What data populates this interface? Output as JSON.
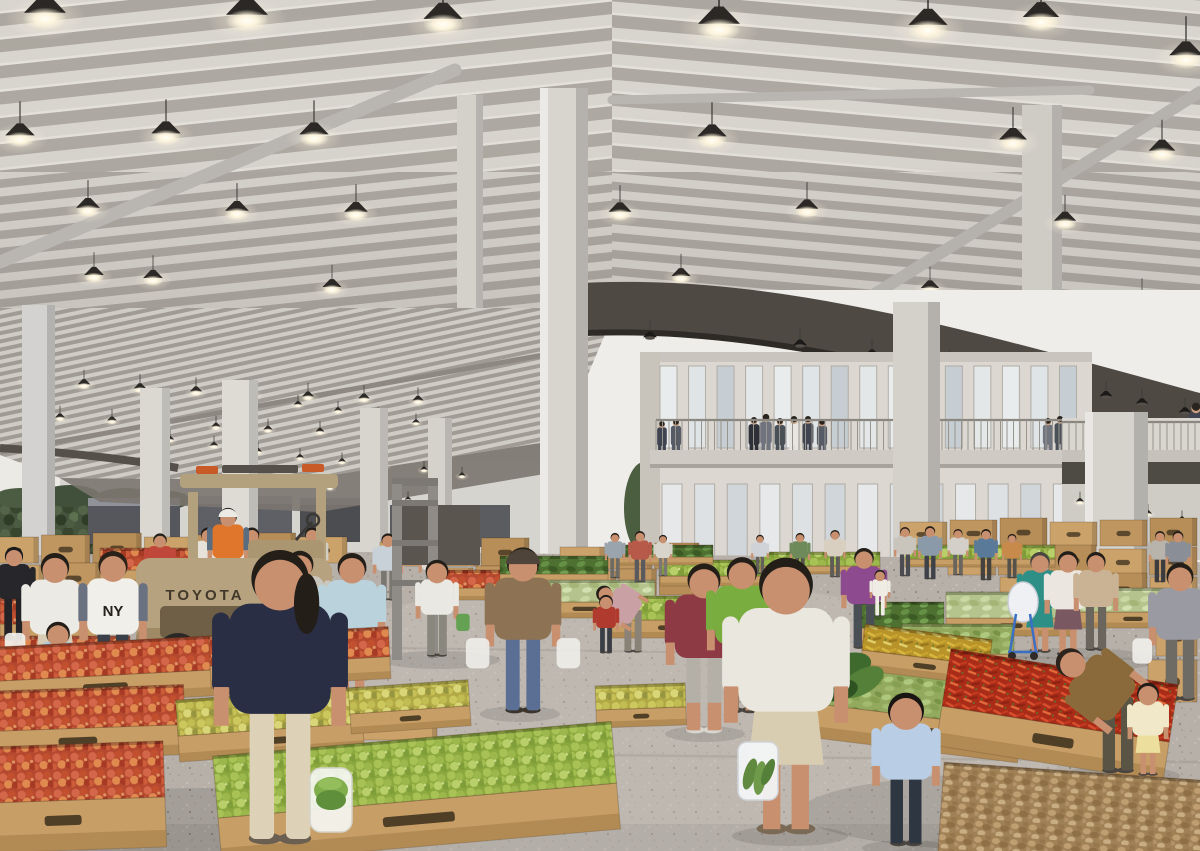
{
  "scene": {
    "title": "Covered fruit and vegetable market hall — architectural rendering",
    "setting": "large market hall with corrugated steel roof, pendant lamps, white columns, two-story office block, wooden produce crates, shoppers and a forklift"
  },
  "texts": {
    "forklift_brand": "TOYOTA",
    "sweatshirt_print": "NY"
  },
  "colors": {
    "roof_light": "#d8d4ce",
    "roof_shadow": "#aba69f",
    "fascia": "#4e4943",
    "column": "#d8d5cf",
    "floor": "#b6b0a9",
    "wood": "#c79e66",
    "wood_dark": "#9f7a45",
    "wood_slot": "#3b2e1c",
    "forklift_body": "#b7a280",
    "vest_orange": "#e0762c",
    "apples": "#c2502f",
    "pears": "#9cb84d",
    "chili_red": "#c23a1f",
    "chili_yellow": "#d9b83f",
    "ginger": "#a08055",
    "leafy_green": "#4e7030",
    "hedge": "#45543c",
    "building_wall": "#dcd8d1",
    "lamp_glow": "#fdf4dd"
  },
  "lamps_main": [
    [
      45,
      15,
      1.5
    ],
    [
      247,
      17,
      1.5
    ],
    [
      443,
      21,
      1.4
    ],
    [
      719,
      26,
      1.5
    ],
    [
      928,
      27,
      1.4
    ],
    [
      1041,
      19,
      1.3
    ],
    [
      1186,
      57,
      1.2
    ],
    [
      20,
      137,
      1.05
    ],
    [
      166,
      135,
      1.05
    ],
    [
      314,
      136,
      1.05
    ],
    [
      712,
      138,
      1.05
    ],
    [
      1013,
      141,
      1.0
    ],
    [
      1162,
      152,
      0.95
    ],
    [
      88,
      209,
      0.85
    ],
    [
      237,
      212,
      0.85
    ],
    [
      356,
      213,
      0.85
    ],
    [
      620,
      213,
      0.82
    ],
    [
      807,
      210,
      0.82
    ],
    [
      1065,
      222,
      0.8
    ],
    [
      94,
      276,
      0.7
    ],
    [
      153,
      279,
      0.7
    ],
    [
      332,
      288,
      0.68
    ],
    [
      681,
      277,
      0.68
    ],
    [
      930,
      289,
      0.66
    ],
    [
      1142,
      300,
      0.64
    ],
    [
      48,
      336,
      0.58
    ],
    [
      116,
      340,
      0.58
    ],
    [
      176,
      344,
      0.56
    ],
    [
      235,
      347,
      0.56
    ],
    [
      293,
      349,
      0.55
    ],
    [
      350,
      352,
      0.54
    ],
    [
      408,
      354,
      0.53
    ],
    [
      656,
      326,
      0.55
    ],
    [
      840,
      349,
      0.52
    ]
  ],
  "lamps_canopy": [
    [
      28,
      381,
      0.45
    ],
    [
      84,
      385,
      0.45
    ],
    [
      140,
      389,
      0.44
    ],
    [
      196,
      392,
      0.43
    ],
    [
      252,
      395,
      0.42
    ],
    [
      308,
      397,
      0.42
    ],
    [
      364,
      399,
      0.41
    ],
    [
      418,
      401,
      0.4
    ],
    [
      60,
      418,
      0.36
    ],
    [
      112,
      421,
      0.35
    ],
    [
      164,
      424,
      0.34
    ],
    [
      216,
      427,
      0.33
    ],
    [
      268,
      430,
      0.33
    ],
    [
      320,
      432,
      0.32
    ],
    [
      298,
      405,
      0.3
    ],
    [
      338,
      411,
      0.29
    ],
    [
      378,
      417,
      0.29
    ],
    [
      416,
      423,
      0.28
    ],
    [
      170,
      440,
      0.3
    ],
    [
      214,
      446,
      0.3
    ],
    [
      258,
      452,
      0.29
    ],
    [
      300,
      458,
      0.29
    ],
    [
      342,
      462,
      0.28
    ],
    [
      384,
      466,
      0.28
    ],
    [
      424,
      470,
      0.27
    ],
    [
      462,
      476,
      0.27
    ],
    [
      330,
      488,
      0.26
    ],
    [
      370,
      494,
      0.26
    ],
    [
      408,
      500,
      0.25
    ]
  ],
  "lamps_mezz": [
    [
      1080,
      502,
      0.3
    ],
    [
      1114,
      508,
      0.3
    ],
    [
      1148,
      514,
      0.29
    ],
    [
      1182,
      520,
      0.28
    ],
    [
      1096,
      530,
      0.27
    ],
    [
      1132,
      536,
      0.27
    ],
    [
      1168,
      542,
      0.26
    ]
  ],
  "dark_cones": [
    [
      650,
      338,
      0.5
    ],
    [
      800,
      346,
      0.5
    ],
    [
      872,
      356,
      0.5
    ],
    [
      950,
      367,
      0.5
    ],
    [
      985,
      373,
      0.48
    ],
    [
      1018,
      379,
      0.48
    ],
    [
      1068,
      390,
      0.46
    ],
    [
      1106,
      397,
      0.46
    ],
    [
      1142,
      404,
      0.44
    ],
    [
      1185,
      413,
      0.44
    ]
  ],
  "building": {
    "upper_windows": {
      "x0": 660,
      "x1": 1088,
      "n": 15,
      "wy": 366,
      "wh": 82,
      "ww": 17
    },
    "lower_windows": {
      "x0": 662,
      "x1": 1086,
      "n": 13,
      "wy": 484,
      "wh": 112,
      "ww": 20
    },
    "rail": {
      "x0": 656,
      "x1": 1090,
      "y0": 420,
      "y1": 450,
      "step": 6.5
    },
    "mezz_rail": {
      "x0": 1062,
      "x1": 1200,
      "y0": 422,
      "y1": 450,
      "step": 7
    },
    "balcony_people": [
      [
        662,
        452,
        30
      ],
      [
        676,
        452,
        32
      ],
      [
        754,
        452,
        34
      ],
      [
        766,
        451,
        36
      ],
      [
        780,
        452,
        33
      ],
      [
        794,
        452,
        35
      ],
      [
        808,
        451,
        34
      ],
      [
        822,
        452,
        32
      ],
      [
        902,
        452,
        30
      ],
      [
        1048,
        451,
        32
      ],
      [
        1060,
        451,
        34
      ],
      [
        1132,
        451,
        33
      ],
      [
        1196,
        450,
        46
      ]
    ],
    "suit_colors": [
      "#3f4450",
      "#565b66",
      "#2e3138",
      "#6f747e",
      "#4a5058",
      "#e8e6e0"
    ]
  },
  "box_strips": [
    {
      "x0": -10,
      "x1": 350,
      "y": 535,
      "h": 28,
      "n": 7
    },
    {
      "x0": -10,
      "x1": 330,
      "y": 563,
      "h": 30,
      "n": 6
    },
    {
      "x0": 140,
      "x1": 365,
      "y": 592,
      "h": 32,
      "n": 4
    },
    {
      "x0": 380,
      "x1": 532,
      "y": 540,
      "h": 26,
      "n": 3
    },
    {
      "x0": 430,
      "x1": 522,
      "y": 566,
      "h": 28,
      "n": 2
    },
    {
      "x0": 560,
      "x1": 702,
      "y": 545,
      "h": 24,
      "n": 3
    },
    {
      "x0": 578,
      "x1": 700,
      "y": 569,
      "h": 26,
      "n": 3
    },
    {
      "x0": 900,
      "x1": 1200,
      "y": 520,
      "h": 26,
      "n": 6
    },
    {
      "x0": 948,
      "x1": 1200,
      "y": 547,
      "h": 28,
      "n": 5
    },
    {
      "x0": 1000,
      "x1": 1200,
      "y": 575,
      "h": 30,
      "n": 4
    },
    {
      "x0": 362,
      "x1": 440,
      "y": 700,
      "h": 40,
      "n": 1
    },
    {
      "x0": 352,
      "x1": 462,
      "y": 742,
      "h": 46,
      "n": 2
    },
    {
      "x0": 1156,
      "x1": 1200,
      "y": 616,
      "h": 40,
      "n": 1
    },
    {
      "x0": 1148,
      "x1": 1200,
      "y": 658,
      "h": 44,
      "n": 1
    }
  ],
  "crates_mid": [
    {
      "x": 100,
      "y": 548,
      "w": 108,
      "h": 22,
      "p": "apples",
      "f": 14
    },
    {
      "x": 0,
      "y": 598,
      "w": 96,
      "h": 26,
      "p": "apples",
      "f": 18
    },
    {
      "x": 0,
      "y": 636,
      "w": 130,
      "h": 30,
      "p": "apples",
      "f": 22
    },
    {
      "x": 443,
      "y": 570,
      "w": 66,
      "h": 18,
      "p": "apples",
      "f": 12
    },
    {
      "x": 500,
      "y": 556,
      "w": 108,
      "h": 18,
      "p": "leafy",
      "f": 12
    },
    {
      "x": 515,
      "y": 580,
      "w": 140,
      "h": 22,
      "p": "melons_light",
      "f": 16
    },
    {
      "x": 612,
      "y": 596,
      "w": 112,
      "h": 24,
      "p": "pears",
      "f": 18
    },
    {
      "x": 660,
      "y": 560,
      "w": 130,
      "h": 16,
      "p": "pears",
      "f": 10
    },
    {
      "x": 618,
      "y": 545,
      "w": 95,
      "h": 12,
      "p": "leafy",
      "f": 8
    },
    {
      "x": 760,
      "y": 552,
      "w": 120,
      "h": 14,
      "p": "pears",
      "f": 8
    },
    {
      "x": 905,
      "y": 545,
      "w": 150,
      "h": 14,
      "p": "pears",
      "f": 8
    },
    {
      "x": 858,
      "y": 602,
      "w": 86,
      "h": 26,
      "p": "leafy",
      "f": 18
    },
    {
      "x": 946,
      "y": 592,
      "w": 130,
      "h": 26,
      "p": "melons_light",
      "f": 18
    },
    {
      "x": 1078,
      "y": 588,
      "w": 110,
      "h": 24,
      "p": "melons_light",
      "f": 16
    },
    {
      "x": 902,
      "y": 624,
      "w": 112,
      "h": 30,
      "p": "melons",
      "f": 22
    }
  ],
  "crates_fgl": [
    {
      "x": -20,
      "y": 648,
      "w": 250,
      "h": 34,
      "p": "apples",
      "f": 26,
      "rot": -3
    },
    {
      "x": 210,
      "y": 636,
      "w": 180,
      "h": 30,
      "p": "apples",
      "f": 22,
      "rot": -3
    },
    {
      "x": -30,
      "y": 692,
      "w": 215,
      "h": 40,
      "p": "apples",
      "f": 30,
      "rot": -2
    },
    {
      "x": 178,
      "y": 700,
      "w": 185,
      "h": 36,
      "p": "pears_y",
      "f": 26,
      "rot": -4
    },
    {
      "x": 350,
      "y": 688,
      "w": 120,
      "h": 26,
      "p": "pears_y",
      "f": 20,
      "rot": -4
    },
    {
      "x": 596,
      "y": 686,
      "w": 90,
      "h": 24,
      "p": "pears_y",
      "f": 18,
      "rot": -2
    },
    {
      "x": -40,
      "y": 748,
      "w": 205,
      "h": 56,
      "p": "apples",
      "f": 50,
      "rot": -2
    },
    {
      "x": 218,
      "y": 756,
      "w": 400,
      "h": 62,
      "p": "pears",
      "f": 46,
      "rot": -5
    }
  ],
  "crates_fgr": [
    {
      "x": 818,
      "y": 658,
      "w": 205,
      "h": 46,
      "p": "melons",
      "f": 34,
      "rot": 7
    },
    {
      "x": 862,
      "y": 624,
      "w": 128,
      "h": 26,
      "p": "chilis_y",
      "f": 20,
      "rot": 7
    },
    {
      "x": 942,
      "y": 648,
      "w": 230,
      "h": 58,
      "p": "chilis_r",
      "f": 40,
      "rot": 9
    }
  ],
  "crates_fgr2": [
    {
      "x": 938,
      "y": 762,
      "w": 270,
      "h": 89,
      "p": "ginger",
      "f": 0,
      "rot": 4
    }
  ],
  "people_far": [
    {
      "x": 160,
      "feet": 602,
      "h": 70,
      "shirt": "#c0483a",
      "pants": "#8a867e"
    },
    {
      "x": 208,
      "feet": 600,
      "h": 74,
      "shirt": "#e6e2da",
      "pants": "#9a958c"
    },
    {
      "x": 252,
      "feet": 602,
      "h": 76,
      "shirt": "#ece8e0",
      "pants": "#b0a89a",
      "skirt": true,
      "skirtC": "#cfc4ae"
    },
    {
      "x": 312,
      "feet": 598,
      "h": 72,
      "shirt": "#d2cec6",
      "pants": "#6a665f"
    },
    {
      "x": 388,
      "feet": 600,
      "h": 68,
      "shirt": "#c8d0d8",
      "pants": "#7a7670"
    },
    {
      "x": 432,
      "feet": 596,
      "h": 60,
      "shirt": "#dedad2",
      "pants": "#8a8680"
    },
    {
      "x": 615,
      "feet": 578,
      "h": 46,
      "shirt": "#9aa4ad",
      "pants": "#6e6a64"
    },
    {
      "x": 640,
      "feet": 582,
      "h": 52,
      "shirt": "#b85a4a",
      "pants": "#5a5a5e"
    },
    {
      "x": 663,
      "feet": 576,
      "h": 42,
      "shirt": "#d8d4cc",
      "pants": "#7a7672"
    },
    {
      "x": 760,
      "feet": 574,
      "h": 40,
      "shirt": "#cfd2d6",
      "pants": "#63605c"
    },
    {
      "x": 800,
      "feet": 578,
      "h": 46,
      "shirt": "#6f8a5a",
      "pants": "#54514d"
    },
    {
      "x": 835,
      "feet": 577,
      "h": 48,
      "shirt": "#d8cfc0",
      "pants": "#5f5b57"
    },
    {
      "x": 905,
      "feet": 576,
      "h": 50,
      "shirt": "#c9c4bc",
      "pants": "#4a4c52"
    },
    {
      "x": 930,
      "feet": 579,
      "h": 54,
      "shirt": "#8a9aa8",
      "pants": "#3f4148"
    },
    {
      "x": 958,
      "feet": 575,
      "h": 47,
      "shirt": "#d4cfc8",
      "pants": "#6a665f"
    },
    {
      "x": 986,
      "feet": 580,
      "h": 52,
      "shirt": "#5a7a9a",
      "pants": "#44423e"
    },
    {
      "x": 1012,
      "feet": 578,
      "h": 45,
      "shirt": "#c88a4a",
      "pants": "#55524c"
    },
    {
      "x": 1160,
      "feet": 582,
      "h": 52,
      "shirt": "#b8b4ac",
      "pants": "#3a3c40"
    },
    {
      "x": 1178,
      "feet": 586,
      "h": 56,
      "shirt": "#8a8e96",
      "pants": "#4e4a46"
    },
    {
      "x": 14,
      "feet": 640,
      "h": 95,
      "shirt": "#27262b",
      "pants": "#232226",
      "hair": "#1b1a1d",
      "name": "shopper-dark-clothing"
    }
  ],
  "forklift_driver": {
    "x": 228,
    "feet": 598,
    "h": 92,
    "shirt": "#e0762c",
    "pants": "#4a5568",
    "hat": "#eceae4",
    "sleeve": "#5a6c80",
    "name": "forklift-driver"
  },
  "people_mid": [
    {
      "x": 55,
      "feet": 698,
      "h": 148,
      "shirt": "#eceae4",
      "pants": "#d8cdb4",
      "skirt": true,
      "skirtC": "#d8cdb4",
      "bag2": "#f2f1ec",
      "name": "shopper-white-tee"
    },
    {
      "x": 113,
      "feet": 700,
      "h": 152,
      "shirt": "#f1efe9",
      "pants": "#3a3f49",
      "sleeve": "#6a7180",
      "hair": "#2a2118",
      "name": "shopper-ny-sweatshirt"
    },
    {
      "x": 58,
      "feet": 722,
      "h": 100,
      "child": true,
      "shirt": "#a9c9e2",
      "skirt": true,
      "skirtC": "#a9c9e2",
      "name": "girl-blue-dress"
    },
    {
      "x": 300,
      "feet": 688,
      "h": 140,
      "shirt": "#c9c6be",
      "pants": "#b2a183",
      "capri": true,
      "name": "shopper-grey-tee"
    },
    {
      "x": 352,
      "feet": 700,
      "h": 150,
      "shirt": "#b9d2dc",
      "skirt": true,
      "skirtC": "#cfd8de",
      "name": "woman-floral-tank"
    },
    {
      "x": 437,
      "feet": 656,
      "h": 96,
      "child": true,
      "shirt": "#eae8e2",
      "pants": "#8a877e",
      "bag": "#5c9e4a",
      "name": "boy-green-bag"
    },
    {
      "x": 523,
      "feet": 712,
      "h": 168,
      "shirt": "#8d7254",
      "pants": "#5b6f94",
      "hat": "#4e443a",
      "bag": "#eeede8",
      "bag2": "#eeede8",
      "shoe": "#3a342c",
      "name": "man-brown-jacket"
    },
    {
      "x": 633,
      "feet": 652,
      "h": 84,
      "bend": true,
      "dir": -1,
      "lean": 58,
      "shirt": "#c9a0a4",
      "pants": "#8a8276",
      "name": "woman-bending-crate"
    },
    {
      "x": 606,
      "feet": 653,
      "h": 58,
      "child": true,
      "shirt": "#b03a2e",
      "pants": "#3a3e44",
      "name": "child-red-shirt"
    },
    {
      "x": 704,
      "feet": 732,
      "h": 172,
      "shirt": "#8e3a44",
      "pants": "#b4b0a8",
      "capri": true,
      "bag": "#f0efe9",
      "shoe": "#d8d5ce",
      "name": "woman-maroon-tee"
    },
    {
      "x": 742,
      "feet": 712,
      "h": 158,
      "shirt": "#79ad3f",
      "pants": "#3e4446",
      "capri": true,
      "name": "woman-green-tee"
    },
    {
      "x": 864,
      "feet": 648,
      "h": 102,
      "shirt": "#8e4a8e",
      "pants": "#4a4e55",
      "name": "woman-purple-top"
    },
    {
      "x": 880,
      "feet": 616,
      "h": 46,
      "child": true,
      "shirt": "#efece4",
      "pants": "#efece4",
      "name": "toddler-carried"
    },
    {
      "x": 1040,
      "feet": 652,
      "h": 102,
      "shirt": "#2e8f86",
      "skirt": true,
      "skirtC": "#2e8f86",
      "hair": "#4a4540",
      "name": "woman-teal-dress"
    },
    {
      "x": 1068,
      "feet": 655,
      "h": 106,
      "shirt": "#ebe7e0",
      "skirt": true,
      "skirtC": "#7a5862",
      "name": "woman-white-cardigan"
    },
    {
      "x": 1096,
      "feet": 650,
      "h": 100,
      "shirt": "#c9b394",
      "pants": "#6a665e",
      "name": "shopper-beige-coat"
    },
    {
      "x": 1180,
      "feet": 700,
      "h": 140,
      "shirt": "#9a9aa2",
      "pants": "#6e6a64",
      "bag2": "#f0efea",
      "name": "man-grey-shirt"
    }
  ],
  "people_fg": [
    {
      "x": 1118,
      "feet": 772,
      "h": 150,
      "bend": true,
      "dir": -1,
      "lean": 52,
      "shirt": "#8a6a3a",
      "pants": "#5a5444",
      "hair": "#2c241c",
      "name": "woman-batik-bending"
    },
    {
      "x": 1148,
      "feet": 775,
      "h": 92,
      "child": true,
      "shirt": "#f0e8c8",
      "skirt": true,
      "skirtC": "#ecdf9e",
      "name": "toddler-yellow-dress"
    }
  ],
  "people_fg2": [
    {
      "x": 280,
      "feet": 842,
      "h": 298,
      "shirt": "#2a2e44",
      "pants": "#ddd2b8",
      "pony": true,
      "shoe": "#6a5f50",
      "name": "woman-navy-tee-foreground"
    },
    {
      "x": 786,
      "feet": 832,
      "h": 280,
      "shirt": "#eae7df",
      "skirt": true,
      "skirtC": "#d8cdb0",
      "shoe": "#7a6a55",
      "name": "woman-white-tee-back"
    },
    {
      "x": 906,
      "feet": 845,
      "h": 152,
      "child": true,
      "shirt": "#b9cde4",
      "pants": "#2e3642",
      "hair": "#191512",
      "name": "child-light-blue-shirt"
    }
  ],
  "shadows": [
    [
      210,
      822,
      250,
      34
    ],
    [
      1040,
      812,
      240,
      40
    ],
    [
      240,
      668,
      120,
      16
    ],
    [
      300,
      846,
      64,
      10
    ],
    [
      790,
      836,
      58,
      10
    ],
    [
      906,
      848,
      44,
      8
    ],
    [
      520,
      714,
      40,
      8
    ],
    [
      705,
      734,
      40,
      8
    ],
    [
      113,
      702,
      36,
      7
    ],
    [
      1120,
      776,
      60,
      10
    ],
    [
      440,
      660,
      60,
      9
    ],
    [
      1070,
      660,
      90,
      12
    ]
  ]
}
